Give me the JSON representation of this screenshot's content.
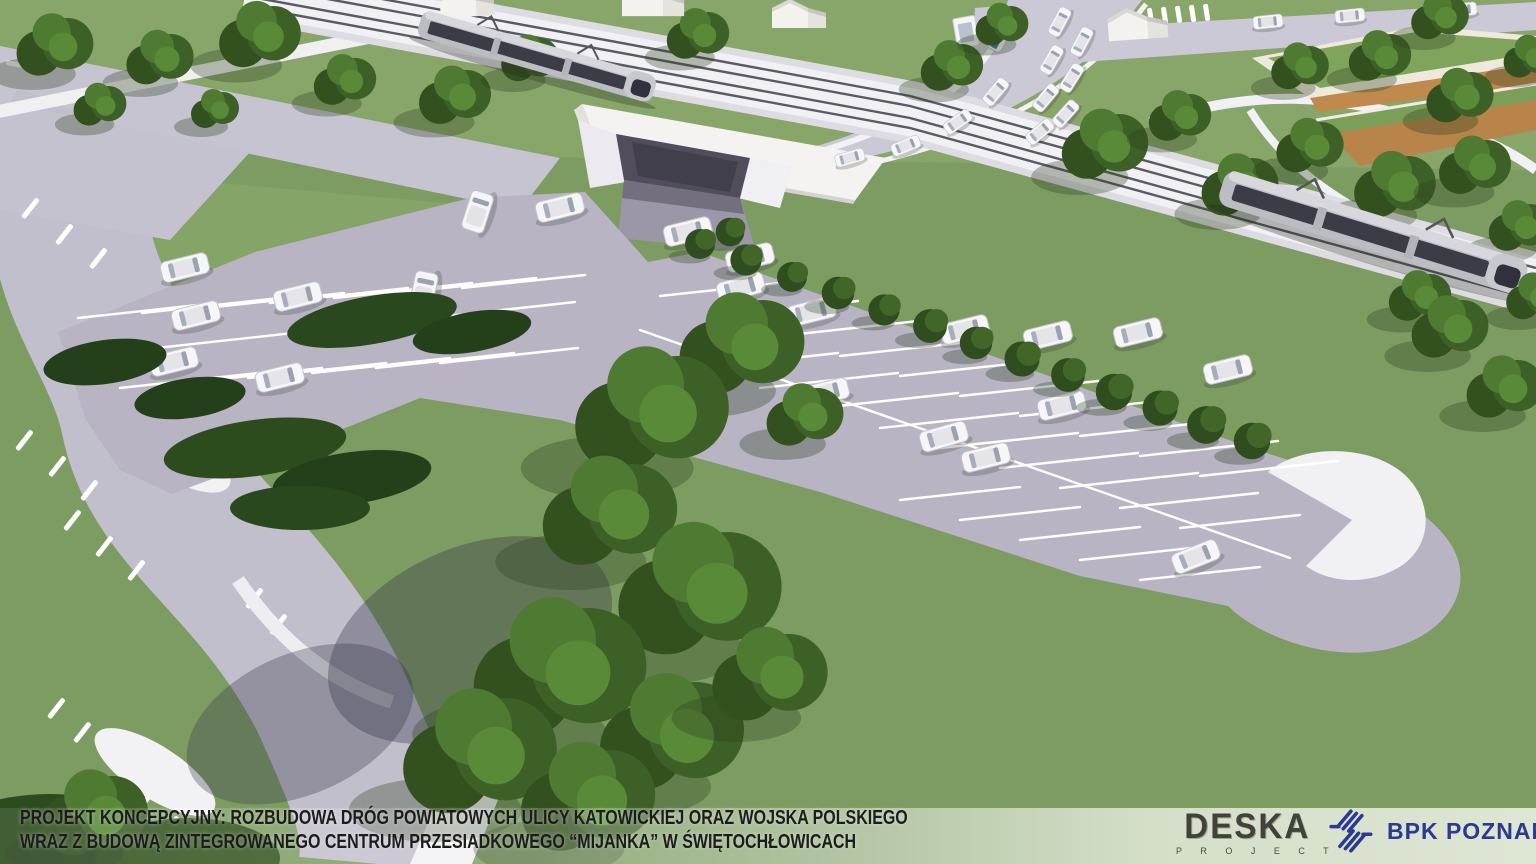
{
  "caption": {
    "line1": "PROJEKT KONCEPCYJNY: ROZBUDOWA DRÓG POWIATOWYCH ULICY KATOWICKIEJ ORAZ WOJSKA POLSKIEGO",
    "line2": "WRAZ Z BUDOWĄ ZINTEGROWANEGO CENTRUM PRZESIADKOWEGO “MIJANKA” W ŚWIĘTOCHŁOWICACH"
  },
  "logos": {
    "deska": {
      "title": "DESKA",
      "subtitle": "P R O J E C T"
    },
    "bpk": {
      "title": "BPK POZNAŃ",
      "icon": "diagonal-hatch-slashes"
    }
  },
  "colors": {
    "grass": "#7D9C62",
    "grass_light": "#8AA96C",
    "parking_asphalt": "#B7B3C2",
    "road": "#C6C3D0",
    "concrete_white": "#F2F1F4",
    "tree_dark": "#2F4D1F",
    "underpass_shadow": "#514D5C",
    "caption_text": "#1C1C1C",
    "deska_logo": "#42423A",
    "bpk_navy": "#2B3990",
    "bottom_band": "rgba(255,255,255,0.55)"
  }
}
